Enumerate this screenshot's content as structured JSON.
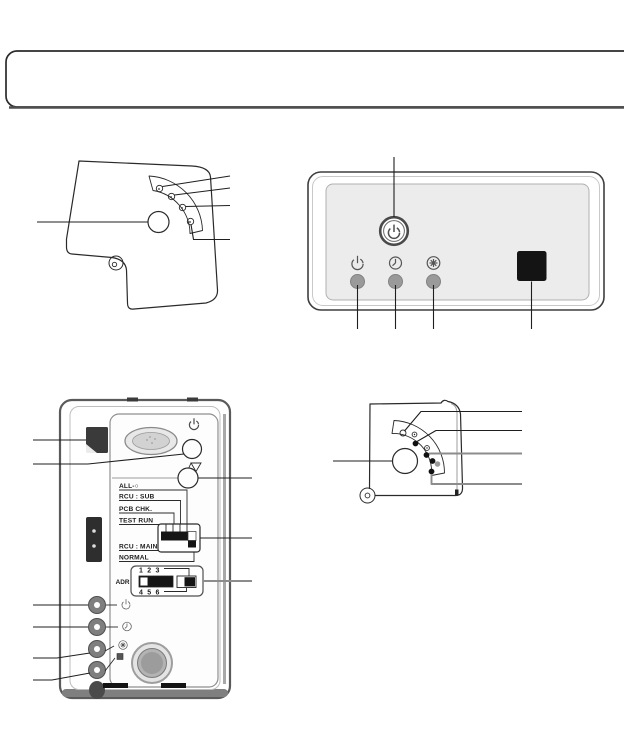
{
  "colors": {
    "outline": "#1f1f1f",
    "callout_gray": "#8c8c8c",
    "panel_fill": "#ececec",
    "led_gray": "#9a9a9a",
    "black_fill": "#141414"
  },
  "receiver_panel": {
    "power_button_icon": "power-icon",
    "indicator_icons": [
      "power-icon",
      "timer-icon",
      "defrost-icon"
    ],
    "led_count": 3,
    "ir_window": "ir-receiver-window"
  },
  "corner_panel_top": {
    "led_count": 4,
    "button": "round-button",
    "callouts_right": 4,
    "callouts_left": 1
  },
  "corner_panel_bottom": {
    "led_count": 5,
    "button": "round-button",
    "callouts_right": 4,
    "callouts_left": 1
  },
  "wall_controller": {
    "dip_block": {
      "labels_top": [
        "ALL-○",
        "RCU : SUB",
        "PCB CHK.",
        "TEST RUN"
      ],
      "labels_bottom": [
        "RCU : MAIN",
        "NORMAL"
      ]
    },
    "adr_block": {
      "label": "ADR",
      "numbers_top": "1 2 3",
      "numbers_bottom": "4 5 6"
    },
    "led_icons": [
      "power-icon",
      "timer-icon",
      "defrost-icon",
      "lamp-icon"
    ],
    "led_count": 4
  }
}
